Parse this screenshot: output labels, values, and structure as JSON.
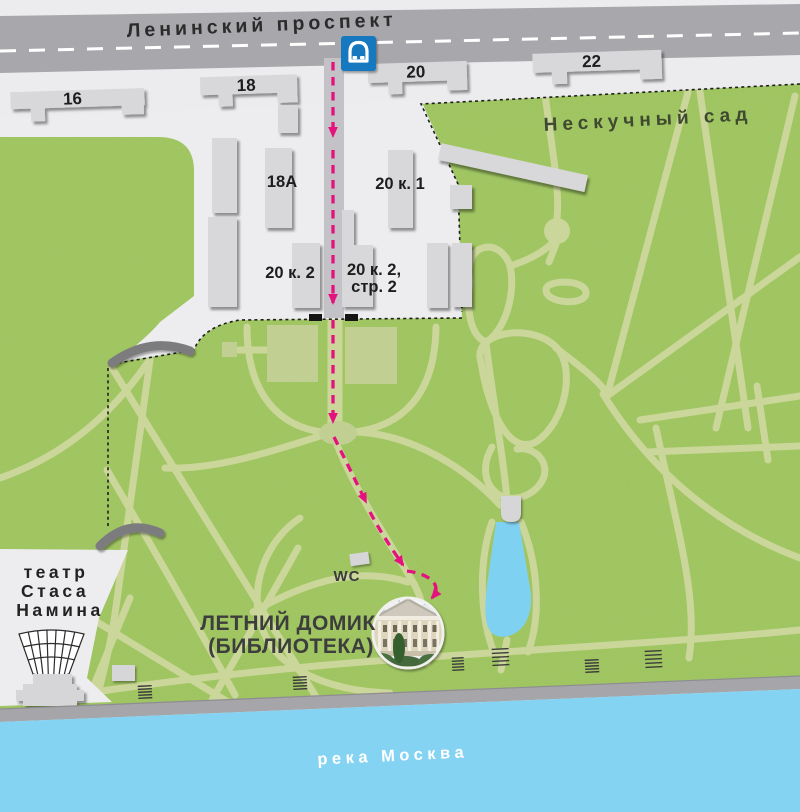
{
  "street": {
    "label": "Ленинский проспект"
  },
  "park": {
    "label": "Нескучный сад"
  },
  "river": {
    "label": "река Москва"
  },
  "buildings": {
    "b16": "16",
    "b18": "18",
    "b20": "20",
    "b22": "22",
    "b18a": "18А",
    "b20k1": "20 к. 1",
    "b20k2": "20 к. 2",
    "b20k2s2_l1": "20 к. 2,",
    "b20k2s2_l2": "стр. 2"
  },
  "wc": {
    "label": "WC"
  },
  "theater": {
    "l1": "театр",
    "l2": "Стаса",
    "l3": "Намина"
  },
  "destination": {
    "l1": "ЛЕТНИЙ ДОМИК",
    "l2": "(БИБЛИОТЕКА)"
  },
  "icons": {
    "metro": "metro-train-icon"
  },
  "colors": {
    "park_green": "#a3c964",
    "path_olive": "#cbd69a",
    "road_gray": "#a8a8ac",
    "river_blue": "#85d3f3",
    "embankment_gray": "#a6a6aa",
    "route_magenta": "#e5117e",
    "metro_blue": "#1478be",
    "courtyard_gray": "#ededef",
    "building_gray": "#d8d8da"
  }
}
